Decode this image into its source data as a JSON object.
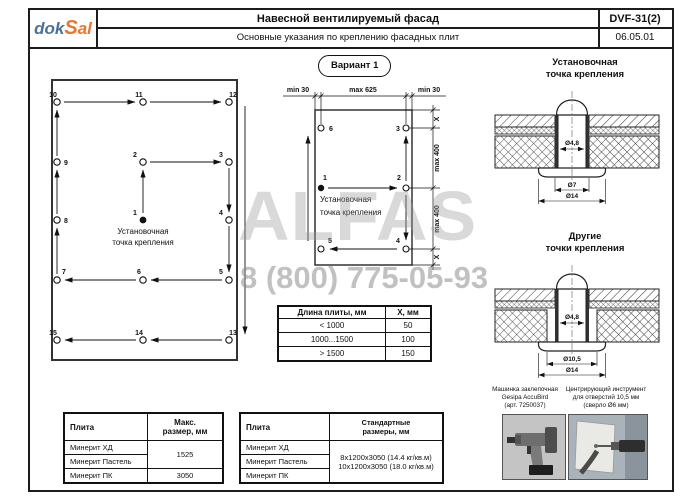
{
  "header": {
    "logo_dok": "dok",
    "logo_s": "S",
    "logo_al": "al",
    "title": "Навесной вентилируемый фасад",
    "subtitle": "Основные указания по креплению фасадных плит",
    "code": "DVF-31(2)",
    "date": "06.05.01"
  },
  "watermark": {
    "brand": "ALFAS",
    "phone": "8 (800) 775-05-93"
  },
  "variant_badge": "Вариант 1",
  "left_diagram": {
    "anchor_label_l1": "Установочная",
    "anchor_label_l2": "точка крепления",
    "points": [
      "1",
      "2",
      "3",
      "4",
      "5",
      "6",
      "7",
      "8",
      "9",
      "10",
      "11",
      "12",
      "13",
      "14",
      "15"
    ]
  },
  "variant_diagram": {
    "dim_min_left": "min 30",
    "dim_max_width": "max 625",
    "dim_min_right": "min 30",
    "dim_x_top": "X",
    "dim_max_top": "max 400",
    "dim_max_bottom": "max 400",
    "dim_x_bottom": "X",
    "anchor_label_l1": "Установочная",
    "anchor_label_l2": "точка крепления",
    "points": [
      "1",
      "2",
      "3",
      "4",
      "5",
      "6"
    ]
  },
  "x_table": {
    "headers": [
      "Длина плиты, мм",
      "X, мм"
    ],
    "rows": [
      [
        "< 1000",
        "50"
      ],
      [
        "1000...1500",
        "100"
      ],
      [
        "> 1500",
        "150"
      ]
    ]
  },
  "anchor_detail": {
    "title": "Установочная\nточка крепления",
    "dia_rivet": "Ø4,8",
    "dia_hole": "Ø7",
    "dia_washer": "Ø14"
  },
  "other_detail": {
    "title": "Другие\nточки крепления",
    "dia_rivet": "Ø4,8",
    "dia_hole": "Ø10,5",
    "dia_washer": "Ø14"
  },
  "max_size_table": {
    "col_plate": "Плита",
    "col_size": "Макс.\nразмер, мм",
    "row1": "Минерит ХД",
    "row2": "Минерит Пастель",
    "row3": "Минерит ПК",
    "size12": "1525",
    "size3": "3050"
  },
  "std_size_table": {
    "col_plate": "Плита",
    "col_size": "Стандартные\nразмеры, мм",
    "row1": "Минерит ХД",
    "row2": "Минерит Пастель",
    "row3": "Минерит ПК",
    "sizes": "8x1200x3050 (14.4 кг/кв.м)\n10x1200x3050 (18.0 кг/кв.м)"
  },
  "tools": {
    "riveter_caption": "Машинка заклепочная\nGesipa AccuBird\n(арт. 7250037)",
    "centering_caption": "Центрирующий инструмент\nдля отверстий 10,5 мм\n(сверло Ø6 мм)"
  },
  "colors": {
    "logo_blue": "#4a7199",
    "logo_orange": "#e8772e",
    "ink": "#111111"
  }
}
